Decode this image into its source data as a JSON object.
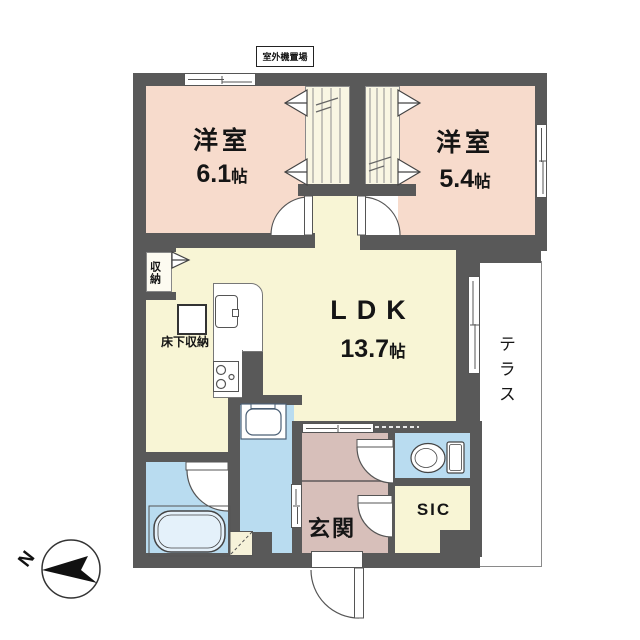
{
  "type": "floor-plan",
  "colors": {
    "wall": "#595959",
    "bedroom_fill": "#f7dbcc",
    "living_fill": "#f8f5d5",
    "closet_fill": "#f9f6e3",
    "wet_area_fill": "#b9dcf0",
    "entry_fill": "#d7bfba",
    "terrace_fill": "#ffffff"
  },
  "rooms": {
    "bedroom1": {
      "name": "洋室",
      "size_value": "6.1",
      "size_unit": "帖"
    },
    "bedroom2": {
      "name": "洋室",
      "size_value": "5.4",
      "size_unit": "帖"
    },
    "ldk": {
      "name": "LDK",
      "size_value": "13.7",
      "size_unit": "帖"
    },
    "genkan": {
      "name": "玄関"
    },
    "sic": {
      "name": "SIC"
    },
    "terrace": {
      "name": "テラス"
    },
    "closet": {
      "name": "収納"
    },
    "floor_storage": {
      "name": "床下収納"
    },
    "outdoor_unit_area": {
      "name": "室外機置場"
    }
  },
  "compass": {
    "north_label": "N"
  }
}
